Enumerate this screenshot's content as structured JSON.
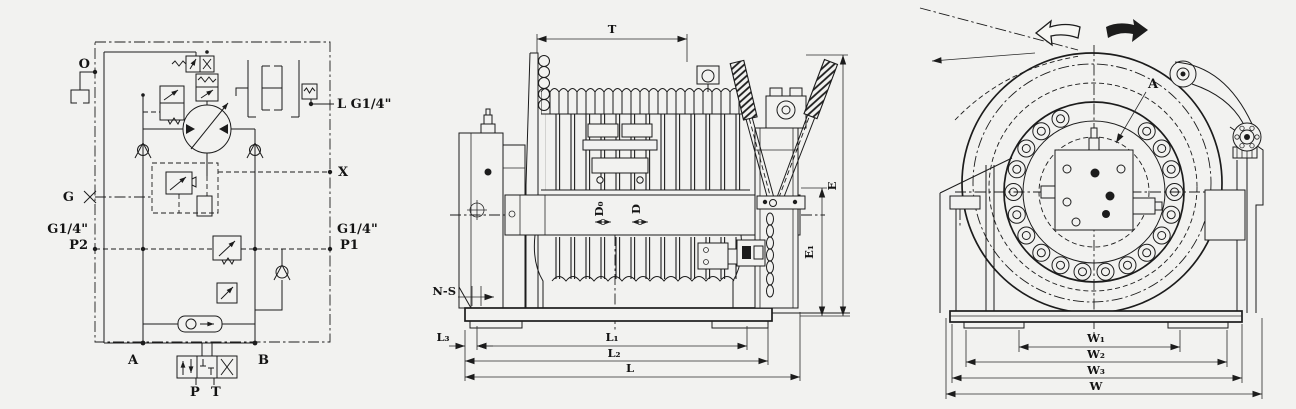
{
  "colors": {
    "background": "#f2f2f0",
    "ink": "#1c1c1c"
  },
  "schematic": {
    "title": "hydraulic-circuit-diagram",
    "ports": {
      "o": "O",
      "g": "G",
      "p2_size": "G1/4\"",
      "p2": "P2",
      "l": "L G1/4\"",
      "x": "X",
      "p1_size": "G1/4\"",
      "p1": "P1",
      "a": "A",
      "b": "B",
      "p": "P",
      "t": "T"
    }
  },
  "front_view": {
    "title": "winch-front-elevation",
    "dims": {
      "t": "T",
      "d0": "D₀",
      "d": "D",
      "e": "E",
      "e1": "E₁",
      "n_s": "N-S",
      "l3": "L₃",
      "l1": "L₁",
      "l2": "L₂",
      "l": "L"
    }
  },
  "side_view": {
    "title": "winch-side-elevation",
    "labels": {
      "a": "A",
      "w1": "W₁",
      "w2": "W₂",
      "w3": "W₃",
      "w": "W"
    }
  }
}
